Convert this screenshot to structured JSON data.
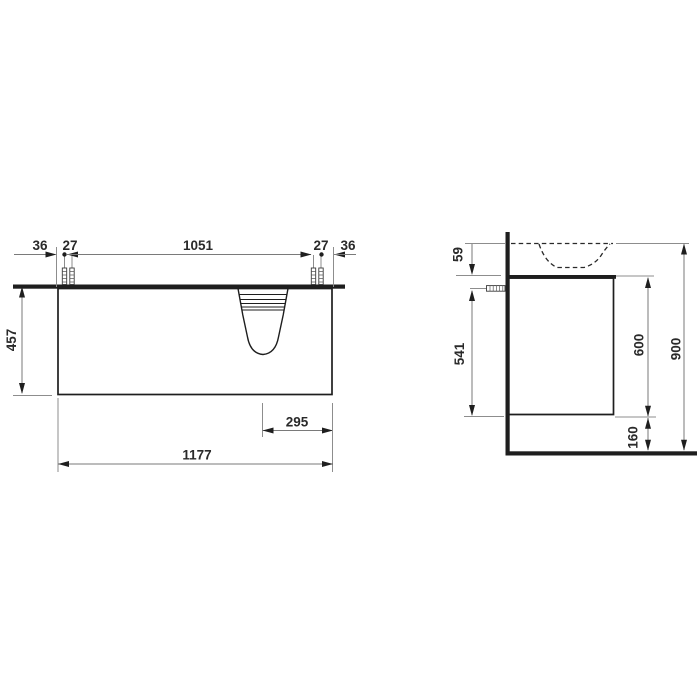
{
  "front_view": {
    "top_offset_left": "36",
    "top_gap_left": "27",
    "top_span": "1051",
    "top_gap_right": "27",
    "top_offset_right": "36",
    "height": "457",
    "basin_to_edge": "295",
    "width": "1177"
  },
  "side_view": {
    "rim": "59",
    "fixing": "541",
    "cabinet": "600",
    "total": "900",
    "clearance": "160"
  },
  "colors": {
    "object_line": "#1e1e1e",
    "dimension_line": "#7a7a7a",
    "label_text": "#2a2a2a",
    "background": "#ffffff"
  }
}
